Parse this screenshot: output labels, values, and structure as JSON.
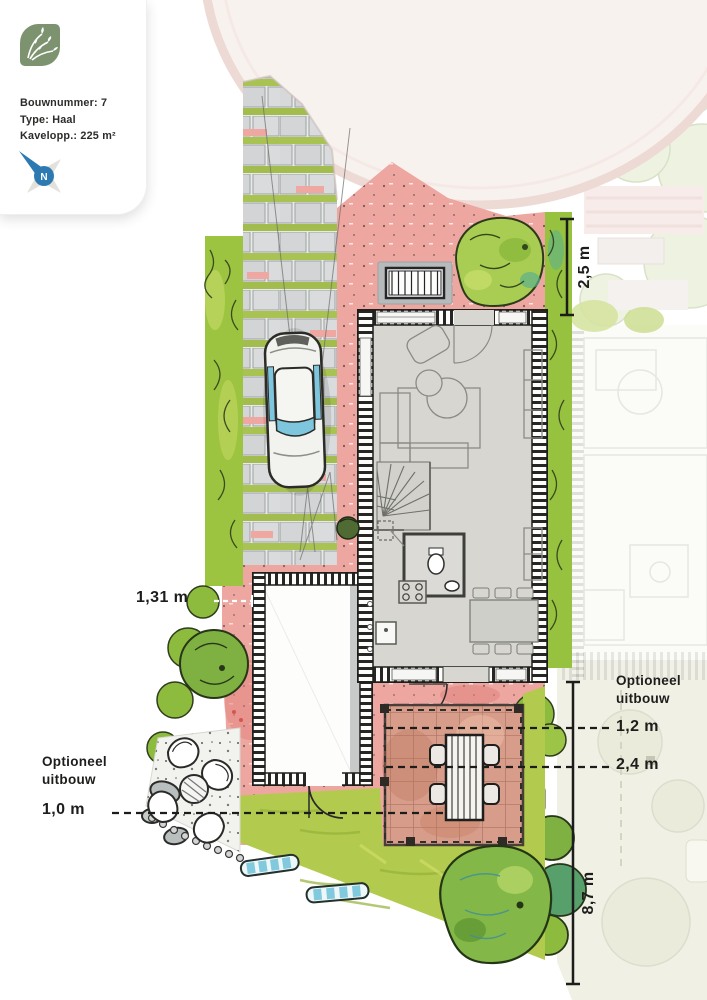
{
  "info_card": {
    "bouwnummer": "Bouwnummer: 7",
    "type": "Type: Haal",
    "kavelopp": "Kavelopp.: 225 m²",
    "compass_label": "N"
  },
  "annotations": {
    "plot_front_width": "2,5 m",
    "side_distance": "1,31 m",
    "optional_extension_right": {
      "label": "Optioneel uitbouw",
      "depth_option_1": "1,2 m",
      "depth_option_2": "2,4 m"
    },
    "optional_extension_left": {
      "label": "Optioneel uitbouw",
      "depth_option": "1,0 m"
    },
    "garden_depth": "8,7 m"
  },
  "colors": {
    "logo_green": "#7d9370",
    "compass_blue": "#2d7ab2",
    "hedge_green": "#9cc440",
    "lawn_green": "#b2cb4e",
    "paving_pink": "#eda6a0",
    "terrace_terracotta": "#d79c8a",
    "floor_gray": "#d7d6d1"
  }
}
